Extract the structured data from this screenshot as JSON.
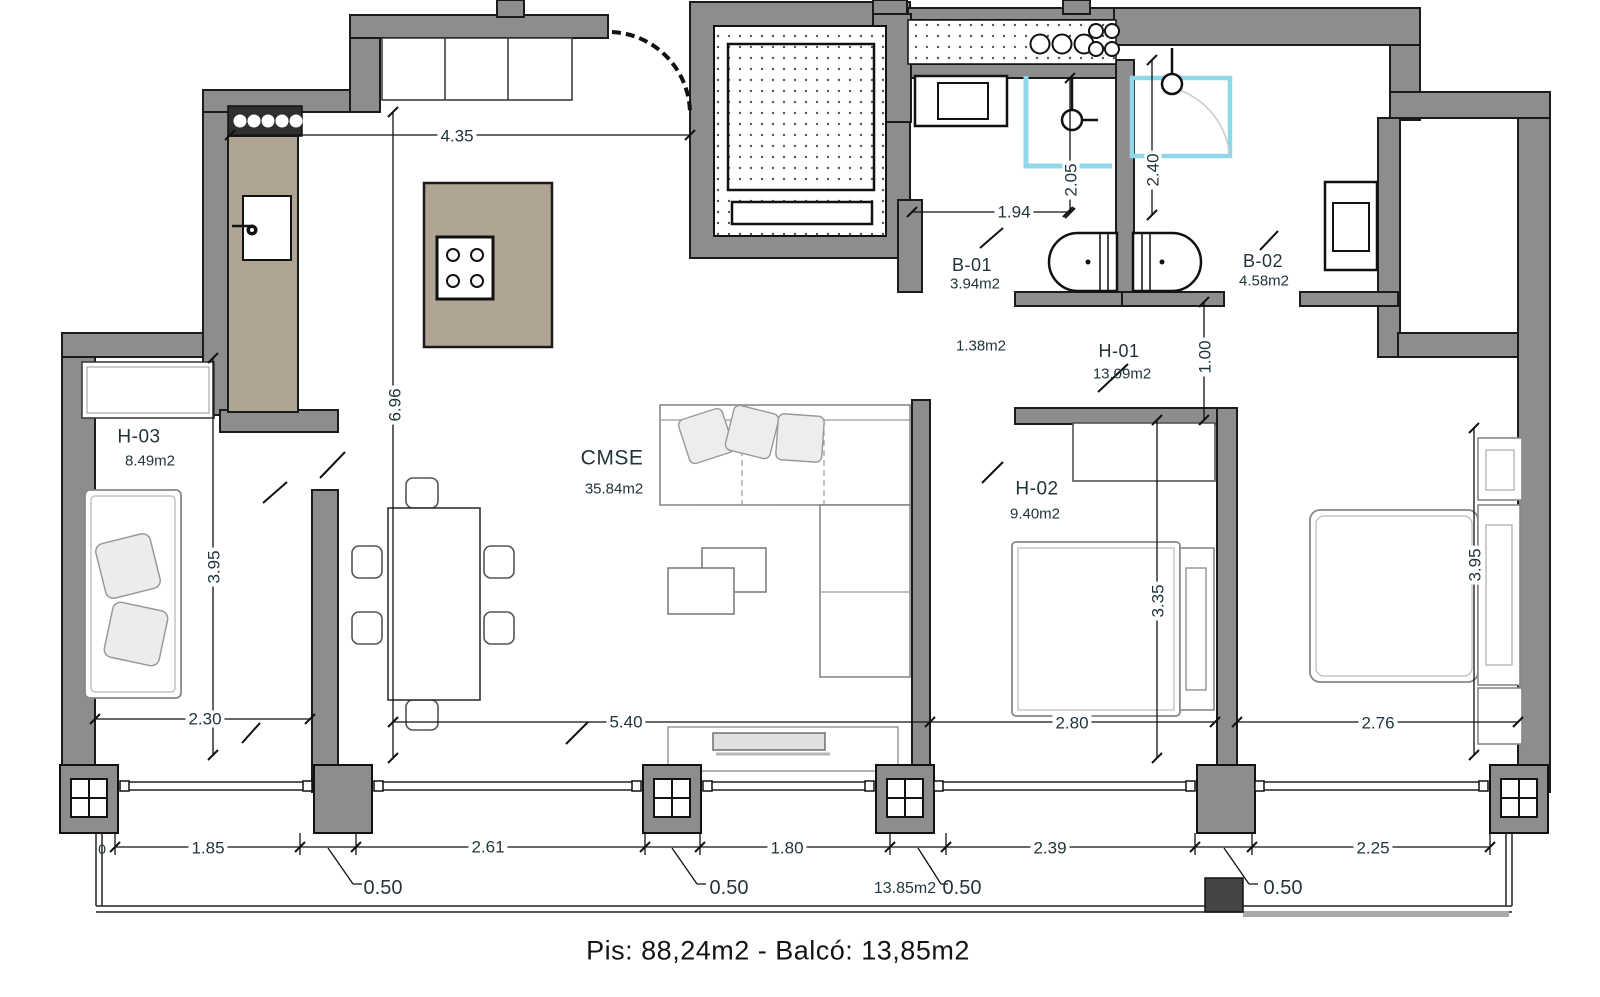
{
  "caption": "Pis: 88,24m2 - Balcó: 13,85m2",
  "rooms": {
    "h03": {
      "name": "H-03",
      "area": "8.49m2"
    },
    "cmse": {
      "name": "CMSE",
      "area": "35.84m2"
    },
    "h02": {
      "name": "H-02",
      "area": "9.40m2"
    },
    "h01": {
      "name": "H-01",
      "area": "13.09m2"
    },
    "b01": {
      "name": "B-01",
      "area": "3.94m2"
    },
    "b02": {
      "name": "B-02",
      "area": "4.58m2"
    }
  },
  "extra_areas": {
    "closet": "1.38m2",
    "balcony": "13,85m2",
    "balcony_label_on_plan": "13.85m2"
  },
  "dimensions": {
    "top_width": "4.35",
    "living_height": "6.96",
    "h03_height": "3.95",
    "h03_width": "2.30",
    "living_width": "5.40",
    "h02_width": "2.80",
    "h01_width": "2.76",
    "h02_bed_span": "3.35",
    "h01_height": "3.95",
    "b01_width": "1.94",
    "b01_shower": "2.05",
    "b02_shower": "2.40",
    "h01_entry": "1.00",
    "edge_left": "0"
  },
  "facade_chain": {
    "segments": [
      "1.85",
      "2.61",
      "1.80",
      "2.39",
      "2.25"
    ],
    "pillar_width": "0.50"
  },
  "colors": {
    "wall": "#8d8d8d",
    "outline": "#1b1b1b",
    "counter": "#b0a594",
    "shower": "#8fd8ea",
    "text": "#24383f"
  }
}
